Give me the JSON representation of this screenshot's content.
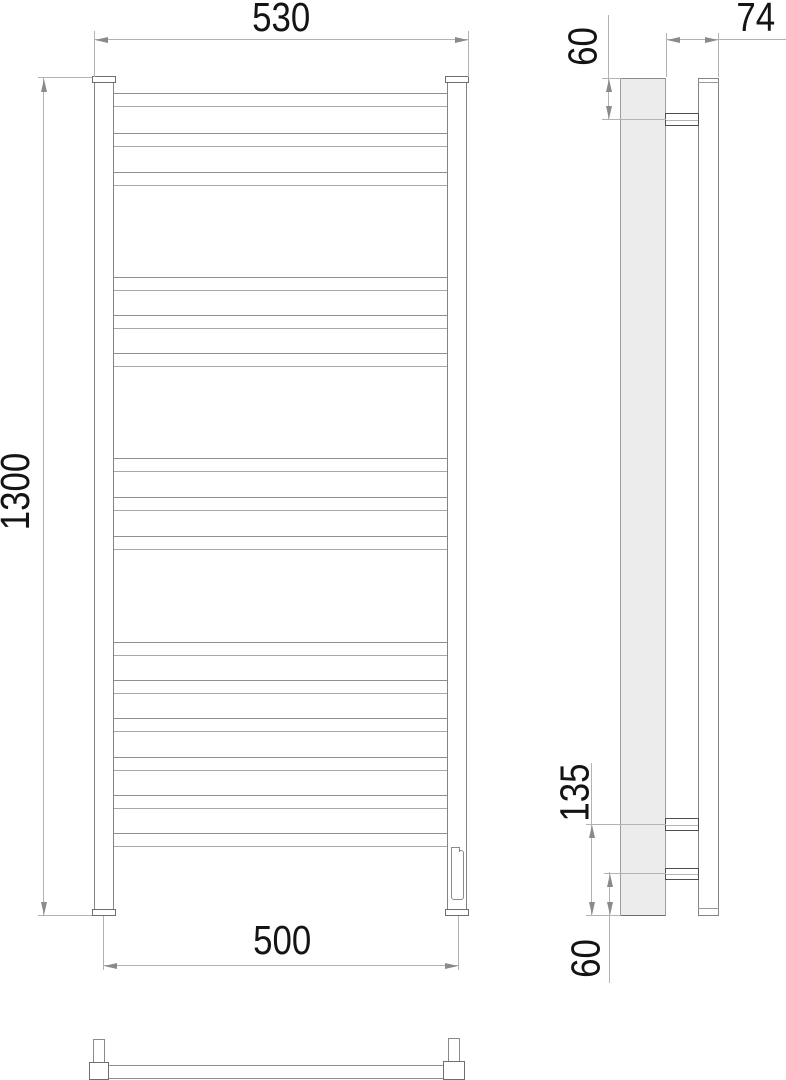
{
  "drawing": {
    "type": "technical-dimension-drawing",
    "subject": "ladder towel rail, front / side / bottom views",
    "dimensions": {
      "overall_width": "530",
      "overall_height": "1300",
      "mounting_centers_width": "500",
      "depth": "74",
      "top_bracket_offset": "60",
      "lower_connection_offset": "135",
      "bottom_bracket_offset": "60"
    },
    "front": {
      "tube_count": 15,
      "tube_groups": [
        3,
        3,
        3,
        6
      ],
      "tube_tops": [
        93,
        133,
        172,
        277,
        315,
        353,
        458,
        497,
        536,
        642,
        680,
        718,
        757,
        795,
        833
      ]
    }
  }
}
